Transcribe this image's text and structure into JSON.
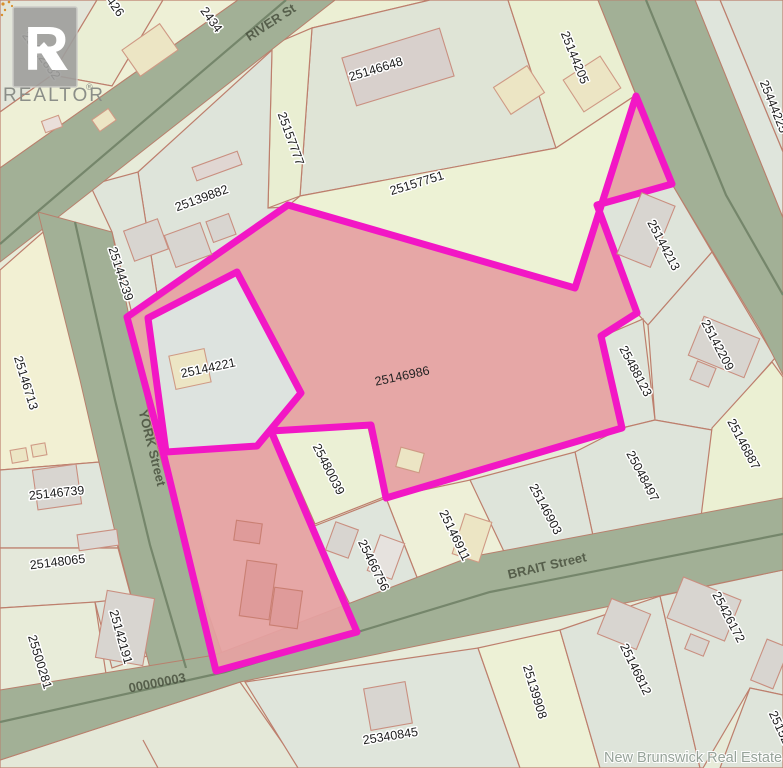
{
  "attribution": "New Brunswick Real Estate Board",
  "logo": {
    "letter": "R",
    "text": "REALTOR",
    "registered": "®"
  },
  "colors": {
    "highlight_outline": "#f217c5",
    "highlight_fill": "#e5a1a1",
    "road": "#a2b096",
    "parcel_line": "#bd7f6d"
  },
  "highlighted_parcel_id": "25146986",
  "streets": [
    {
      "name": "RIVER St"
    },
    {
      "name": "YORK Street"
    },
    {
      "name": "BRAIT Street"
    },
    {
      "name": "00000003"
    }
  ],
  "parcels": [
    {
      "id": "25422832"
    },
    {
      "id": "426"
    },
    {
      "id": "2434"
    },
    {
      "id": "25146648"
    },
    {
      "id": "25157777"
    },
    {
      "id": "25157751"
    },
    {
      "id": "25144205"
    },
    {
      "id": "25444225"
    },
    {
      "id": "25139882"
    },
    {
      "id": "25144239"
    },
    {
      "id": "25146713"
    },
    {
      "id": "25144221"
    },
    {
      "id": "25146986"
    },
    {
      "id": "25144213"
    },
    {
      "id": "25142209"
    },
    {
      "id": "25488123"
    },
    {
      "id": "25048497"
    },
    {
      "id": "25146887"
    },
    {
      "id": "25146903"
    },
    {
      "id": "25146911"
    },
    {
      "id": "25466756"
    },
    {
      "id": "25480039"
    },
    {
      "id": "25146739"
    },
    {
      "id": "25148065"
    },
    {
      "id": "25500281"
    },
    {
      "id": "25142191"
    },
    {
      "id": "25340845"
    },
    {
      "id": "25139908"
    },
    {
      "id": "25146812"
    },
    {
      "id": "25426172"
    },
    {
      "id": "25152"
    }
  ]
}
